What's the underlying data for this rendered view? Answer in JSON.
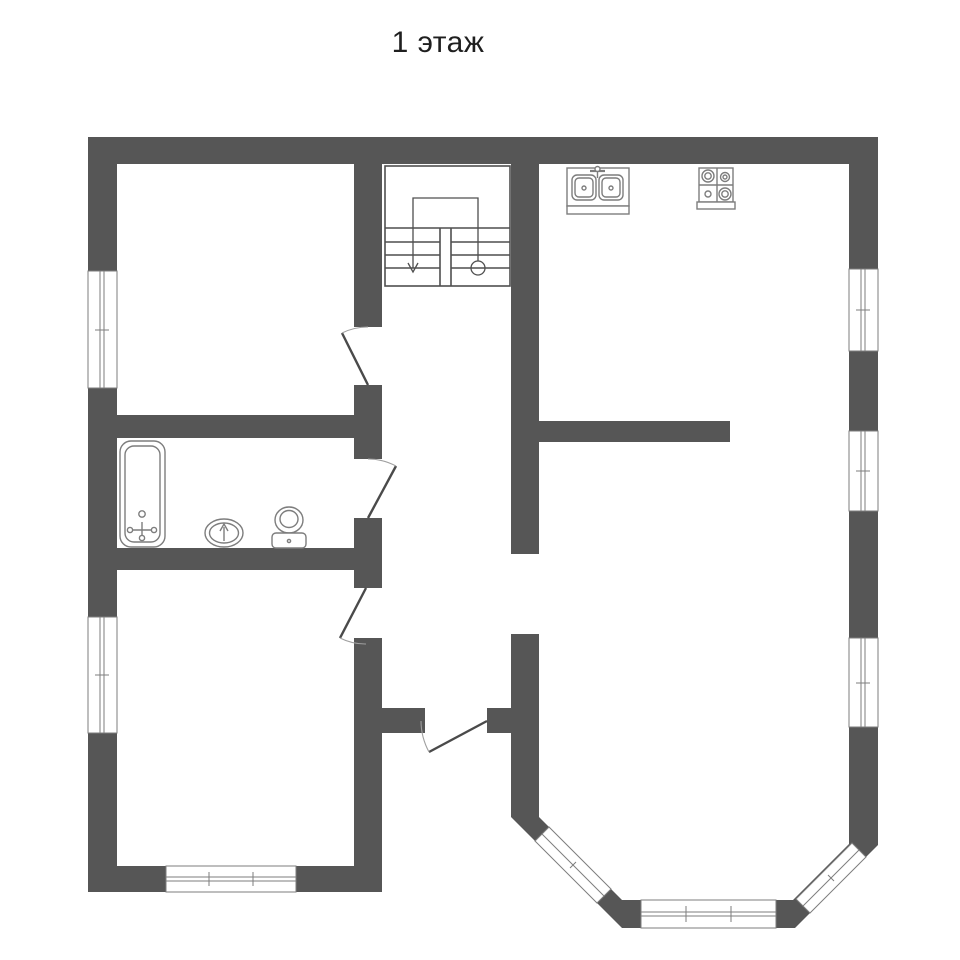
{
  "title": "1 этаж",
  "palette": {
    "background": "#ffffff",
    "wall": "#565656",
    "window_border": "#7d7d7d",
    "fixture_line": "#7d7d7d",
    "door_leaf": "#4a4a4a",
    "door_arc": "#9f9f9f",
    "stair_line": "#4f4f4f",
    "title_color": "#1f1f1f"
  },
  "plan": {
    "canvas": {
      "w": 960,
      "h": 960
    },
    "groups": [
      {
        "name": "walls",
        "f": "#565656",
        "shapes": [
          {
            "t": "rect",
            "x": 88,
            "y": 137,
            "w": 790,
            "h": 27
          },
          {
            "t": "rect",
            "x": 88,
            "y": 137,
            "w": 29,
            "h": 755
          },
          {
            "t": "rect",
            "x": 849,
            "y": 137,
            "w": 29,
            "h": 664
          },
          {
            "t": "rect",
            "x": 88,
            "y": 866,
            "w": 294,
            "h": 26
          },
          {
            "t": "rect",
            "x": 354,
            "y": 164,
            "w": 28,
            "h": 163
          },
          {
            "t": "rect",
            "x": 354,
            "y": 385,
            "w": 28,
            "h": 74
          },
          {
            "t": "rect",
            "x": 354,
            "y": 518,
            "w": 28,
            "h": 70
          },
          {
            "t": "rect",
            "x": 354,
            "y": 638,
            "w": 28,
            "h": 254
          },
          {
            "t": "rect",
            "x": 117,
            "y": 415,
            "w": 265,
            "h": 23
          },
          {
            "t": "rect",
            "x": 117,
            "y": 548,
            "w": 265,
            "h": 22
          },
          {
            "t": "rect",
            "x": 511,
            "y": 164,
            "w": 28,
            "h": 390
          },
          {
            "t": "rect",
            "x": 511,
            "y": 634,
            "w": 28,
            "h": 74
          },
          {
            "t": "rect",
            "x": 511,
            "y": 733,
            "w": 28,
            "h": 84
          },
          {
            "t": "rect",
            "x": 382,
            "y": 708,
            "w": 43,
            "h": 25
          },
          {
            "t": "rect",
            "x": 487,
            "y": 708,
            "w": 52,
            "h": 25
          },
          {
            "t": "rect",
            "x": 539,
            "y": 421,
            "w": 191,
            "h": 21
          },
          {
            "t": "poly",
            "pts": "511,817 539,817 622,900 622,928"
          },
          {
            "t": "rect",
            "x": 622,
            "y": 900,
            "w": 173,
            "h": 28
          },
          {
            "t": "poly",
            "pts": "793,900 849,844 849,801 878,801 878,845 795,928 793,928"
          }
        ]
      },
      {
        "name": "window-left-1",
        "f": "#ffffff",
        "s": "#7d7d7d",
        "sw": 1,
        "shapes": [
          {
            "t": "rect",
            "x": 88,
            "y": 271,
            "w": 29,
            "h": 117
          },
          {
            "t": "line",
            "x1": 100,
            "y1": 271,
            "x2": 100,
            "y2": 388
          },
          {
            "t": "line",
            "x1": 104,
            "y1": 271,
            "x2": 104,
            "y2": 388
          },
          {
            "t": "line",
            "x1": 95,
            "y1": 330,
            "x2": 109,
            "y2": 330
          }
        ]
      },
      {
        "name": "window-left-2",
        "f": "#ffffff",
        "s": "#7d7d7d",
        "sw": 1,
        "shapes": [
          {
            "t": "rect",
            "x": 88,
            "y": 617,
            "w": 29,
            "h": 116
          },
          {
            "t": "line",
            "x1": 100,
            "y1": 617,
            "x2": 100,
            "y2": 733
          },
          {
            "t": "line",
            "x1": 104,
            "y1": 617,
            "x2": 104,
            "y2": 733
          },
          {
            "t": "line",
            "x1": 95,
            "y1": 675,
            "x2": 109,
            "y2": 675
          }
        ]
      },
      {
        "name": "window-right-1",
        "f": "#ffffff",
        "s": "#7d7d7d",
        "sw": 1,
        "shapes": [
          {
            "t": "rect",
            "x": 849,
            "y": 269,
            "w": 29,
            "h": 82
          },
          {
            "t": "line",
            "x1": 861,
            "y1": 269,
            "x2": 861,
            "y2": 351
          },
          {
            "t": "line",
            "x1": 865,
            "y1": 269,
            "x2": 865,
            "y2": 351
          },
          {
            "t": "line",
            "x1": 856,
            "y1": 310,
            "x2": 870,
            "y2": 310
          }
        ]
      },
      {
        "name": "window-right-2",
        "f": "#ffffff",
        "s": "#7d7d7d",
        "sw": 1,
        "shapes": [
          {
            "t": "rect",
            "x": 849,
            "y": 431,
            "w": 29,
            "h": 80
          },
          {
            "t": "line",
            "x1": 861,
            "y1": 431,
            "x2": 861,
            "y2": 511
          },
          {
            "t": "line",
            "x1": 865,
            "y1": 431,
            "x2": 865,
            "y2": 511
          },
          {
            "t": "line",
            "x1": 856,
            "y1": 471,
            "x2": 870,
            "y2": 471
          }
        ]
      },
      {
        "name": "window-right-3",
        "f": "#ffffff",
        "s": "#7d7d7d",
        "sw": 1,
        "shapes": [
          {
            "t": "rect",
            "x": 849,
            "y": 638,
            "w": 29,
            "h": 89
          },
          {
            "t": "line",
            "x1": 861,
            "y1": 638,
            "x2": 861,
            "y2": 727
          },
          {
            "t": "line",
            "x1": 865,
            "y1": 638,
            "x2": 865,
            "y2": 727
          },
          {
            "t": "line",
            "x1": 856,
            "y1": 683,
            "x2": 870,
            "y2": 683
          }
        ]
      },
      {
        "name": "window-bottom",
        "f": "#ffffff",
        "s": "#7d7d7d",
        "sw": 1,
        "shapes": [
          {
            "t": "rect",
            "x": 166,
            "y": 866,
            "w": 130,
            "h": 26
          },
          {
            "t": "line",
            "x1": 166,
            "y1": 877,
            "x2": 296,
            "y2": 877
          },
          {
            "t": "line",
            "x1": 166,
            "y1": 881,
            "x2": 296,
            "y2": 881
          },
          {
            "t": "line",
            "x1": 209,
            "y1": 872,
            "x2": 209,
            "y2": 886
          },
          {
            "t": "line",
            "x1": 253,
            "y1": 872,
            "x2": 253,
            "y2": 886
          }
        ]
      },
      {
        "name": "window-bay-left",
        "f": "#ffffff",
        "s": "#7d7d7d",
        "sw": 1,
        "shapes": [
          {
            "t": "poly",
            "pts": "535,841 549,827 611,889 597,903"
          },
          {
            "t": "line",
            "x1": 542,
            "y1": 834,
            "x2": 604,
            "y2": 896
          },
          {
            "t": "line",
            "x1": 570,
            "y1": 868,
            "x2": 576,
            "y2": 862
          }
        ]
      },
      {
        "name": "window-bay-bottom",
        "f": "#ffffff",
        "s": "#7d7d7d",
        "sw": 1,
        "shapes": [
          {
            "t": "rect",
            "x": 641,
            "y": 900,
            "w": 135,
            "h": 28
          },
          {
            "t": "line",
            "x1": 641,
            "y1": 912,
            "x2": 776,
            "y2": 912
          },
          {
            "t": "line",
            "x1": 641,
            "y1": 916,
            "x2": 776,
            "y2": 916
          },
          {
            "t": "line",
            "x1": 686,
            "y1": 906,
            "x2": 686,
            "y2": 922
          },
          {
            "t": "line",
            "x1": 731,
            "y1": 906,
            "x2": 731,
            "y2": 922
          }
        ]
      },
      {
        "name": "window-bay-right",
        "f": "#ffffff",
        "s": "#7d7d7d",
        "sw": 1,
        "shapes": [
          {
            "t": "poly",
            "pts": "810,913 796,899 852,843 866,857"
          },
          {
            "t": "line",
            "x1": 803,
            "y1": 906,
            "x2": 859,
            "y2": 850
          },
          {
            "t": "line",
            "x1": 828,
            "y1": 875,
            "x2": 834,
            "y2": 881
          }
        ]
      },
      {
        "name": "staircase",
        "f": "none",
        "s": "#4f4f4f",
        "sw": 1.6,
        "shapes": [
          {
            "t": "rect",
            "x": 385,
            "y": 166,
            "w": 125,
            "h": 120
          },
          {
            "t": "line",
            "x1": 385,
            "y1": 228,
            "x2": 510,
            "y2": 228
          },
          {
            "t": "line",
            "x1": 385,
            "y1": 242,
            "x2": 440,
            "y2": 242
          },
          {
            "t": "line",
            "x1": 385,
            "y1": 255,
            "x2": 440,
            "y2": 255
          },
          {
            "t": "line",
            "x1": 385,
            "y1": 268,
            "x2": 440,
            "y2": 268
          },
          {
            "t": "line",
            "x1": 451,
            "y1": 242,
            "x2": 510,
            "y2": 242
          },
          {
            "t": "line",
            "x1": 451,
            "y1": 255,
            "x2": 510,
            "y2": 255
          },
          {
            "t": "line",
            "x1": 451,
            "y1": 268,
            "x2": 510,
            "y2": 268
          },
          {
            "t": "line",
            "x1": 440,
            "y1": 228,
            "x2": 440,
            "y2": 286
          },
          {
            "t": "line",
            "x1": 451,
            "y1": 228,
            "x2": 451,
            "y2": 286
          },
          {
            "t": "path",
            "d": "M413,268 L413,198 L478,198 L478,261",
            "sw": 1.3
          },
          {
            "t": "path",
            "d": "M408,263 L413,272 L418,263",
            "sw": 1.3
          },
          {
            "t": "circle",
            "cx": 478,
            "cy": 268,
            "r": 7,
            "sw": 1.3
          }
        ]
      },
      {
        "name": "door-top-room",
        "f": "none",
        "shapes": [
          {
            "t": "line",
            "x1": 368,
            "y1": 385,
            "x2": 342,
            "y2": 333,
            "s": "#4a4a4a",
            "sw": 2.4
          },
          {
            "t": "path",
            "d": "M368,327 A58,58 0 0 0 342,333",
            "s": "#9f9f9f",
            "sw": 1.1
          }
        ]
      },
      {
        "name": "door-bathroom",
        "f": "none",
        "shapes": [
          {
            "t": "line",
            "x1": 368,
            "y1": 518,
            "x2": 396,
            "y2": 466,
            "s": "#4a4a4a",
            "sw": 2.4
          },
          {
            "t": "path",
            "d": "M368,459 A59,59 0 0 1 396,466",
            "s": "#9f9f9f",
            "sw": 1.1
          }
        ]
      },
      {
        "name": "door-bottom-room",
        "f": "none",
        "shapes": [
          {
            "t": "line",
            "x1": 366,
            "y1": 588,
            "x2": 340,
            "y2": 638,
            "s": "#4a4a4a",
            "sw": 2.4
          },
          {
            "t": "path",
            "d": "M366,644 A56,56 0 0 1 340,638",
            "s": "#9f9f9f",
            "sw": 1.1
          }
        ]
      },
      {
        "name": "door-entrance",
        "f": "none",
        "shapes": [
          {
            "t": "line",
            "x1": 487,
            "y1": 721,
            "x2": 429,
            "y2": 752,
            "s": "#4a4a4a",
            "sw": 2.4
          },
          {
            "t": "path",
            "d": "M421,721 A66,66 0 0 0 429,752",
            "s": "#9f9f9f",
            "sw": 1.1
          }
        ]
      },
      {
        "name": "bathtub",
        "f": "#ffffff",
        "s": "#7d7d7d",
        "sw": 1.4,
        "shapes": [
          {
            "t": "rect",
            "x": 120,
            "y": 441,
            "w": 45,
            "h": 106,
            "rx": 11
          },
          {
            "t": "rect",
            "x": 125,
            "y": 446,
            "w": 35,
            "h": 96,
            "rx": 9
          },
          {
            "t": "circle",
            "cx": 142,
            "cy": 514,
            "r": 3.2
          },
          {
            "t": "line",
            "x1": 142,
            "y1": 522,
            "x2": 142,
            "y2": 538
          },
          {
            "t": "line",
            "x1": 130,
            "y1": 530,
            "x2": 154,
            "y2": 530
          },
          {
            "t": "circle",
            "cx": 130,
            "cy": 530,
            "r": 2.6
          },
          {
            "t": "circle",
            "cx": 154,
            "cy": 530,
            "r": 2.6
          },
          {
            "t": "circle",
            "cx": 142,
            "cy": 538,
            "r": 2.6
          }
        ]
      },
      {
        "name": "washbasin",
        "f": "#ffffff",
        "s": "#7d7d7d",
        "sw": 1.4,
        "shapes": [
          {
            "t": "ellipse",
            "cx": 224,
            "cy": 533,
            "rx": 19,
            "ry": 14
          },
          {
            "t": "ellipse",
            "cx": 224,
            "cy": 533,
            "rx": 14.5,
            "ry": 10
          },
          {
            "t": "line",
            "x1": 224,
            "y1": 541,
            "x2": 224,
            "y2": 527
          },
          {
            "t": "path",
            "d": "M220,531 L224,524 L228,531"
          }
        ]
      },
      {
        "name": "toilet",
        "f": "#ffffff",
        "s": "#7d7d7d",
        "sw": 1.4,
        "shapes": [
          {
            "t": "ellipse",
            "cx": 289,
            "cy": 520,
            "rx": 14,
            "ry": 13
          },
          {
            "t": "ellipse",
            "cx": 289,
            "cy": 519,
            "rx": 9,
            "ry": 8.5
          },
          {
            "t": "rect",
            "x": 272,
            "y": 533,
            "w": 34,
            "h": 15,
            "rx": 4
          },
          {
            "t": "circle",
            "cx": 289,
            "cy": 541,
            "r": 1.6
          }
        ]
      },
      {
        "name": "kitchen-sink",
        "f": "#ffffff",
        "s": "#7d7d7d",
        "sw": 1.4,
        "shapes": [
          {
            "t": "rect",
            "x": 567,
            "y": 168,
            "w": 62,
            "h": 38
          },
          {
            "t": "rect",
            "x": 567,
            "y": 206,
            "w": 62,
            "h": 8
          },
          {
            "t": "rect",
            "x": 572,
            "y": 175,
            "w": 24,
            "h": 25,
            "rx": 5
          },
          {
            "t": "rect",
            "x": 575,
            "y": 178,
            "w": 18,
            "h": 19,
            "rx": 4
          },
          {
            "t": "circle",
            "cx": 584,
            "cy": 188,
            "r": 2
          },
          {
            "t": "rect",
            "x": 599,
            "y": 175,
            "w": 24,
            "h": 25,
            "rx": 5
          },
          {
            "t": "rect",
            "x": 602,
            "y": 178,
            "w": 18,
            "h": 19,
            "rx": 4
          },
          {
            "t": "circle",
            "cx": 611,
            "cy": 188,
            "r": 2
          },
          {
            "t": "line",
            "x1": 590,
            "y1": 171,
            "x2": 605,
            "y2": 171,
            "sw": 2.2
          },
          {
            "t": "circle",
            "cx": 597.5,
            "cy": 169,
            "r": 2.5
          },
          {
            "t": "line",
            "x1": 597.5,
            "y1": 172,
            "x2": 597.5,
            "y2": 178
          }
        ]
      },
      {
        "name": "stove",
        "f": "#ffffff",
        "s": "#7d7d7d",
        "sw": 1.4,
        "shapes": [
          {
            "t": "rect",
            "x": 699,
            "y": 168,
            "w": 34,
            "h": 34
          },
          {
            "t": "line",
            "x1": 717,
            "y1": 168,
            "x2": 717,
            "y2": 202
          },
          {
            "t": "line",
            "x1": 699,
            "y1": 185,
            "x2": 733,
            "y2": 185
          },
          {
            "t": "circle",
            "cx": 708,
            "cy": 176,
            "r": 6
          },
          {
            "t": "circle",
            "cx": 708,
            "cy": 176,
            "r": 3.2
          },
          {
            "t": "circle",
            "cx": 725,
            "cy": 177,
            "r": 4.5
          },
          {
            "t": "circle",
            "cx": 725,
            "cy": 177,
            "r": 2
          },
          {
            "t": "circle",
            "cx": 708,
            "cy": 194,
            "r": 3
          },
          {
            "t": "circle",
            "cx": 725,
            "cy": 194,
            "r": 6
          },
          {
            "t": "circle",
            "cx": 725,
            "cy": 194,
            "r": 3.2
          },
          {
            "t": "rect",
            "x": 697,
            "y": 202,
            "w": 38,
            "h": 7
          }
        ]
      }
    ]
  }
}
